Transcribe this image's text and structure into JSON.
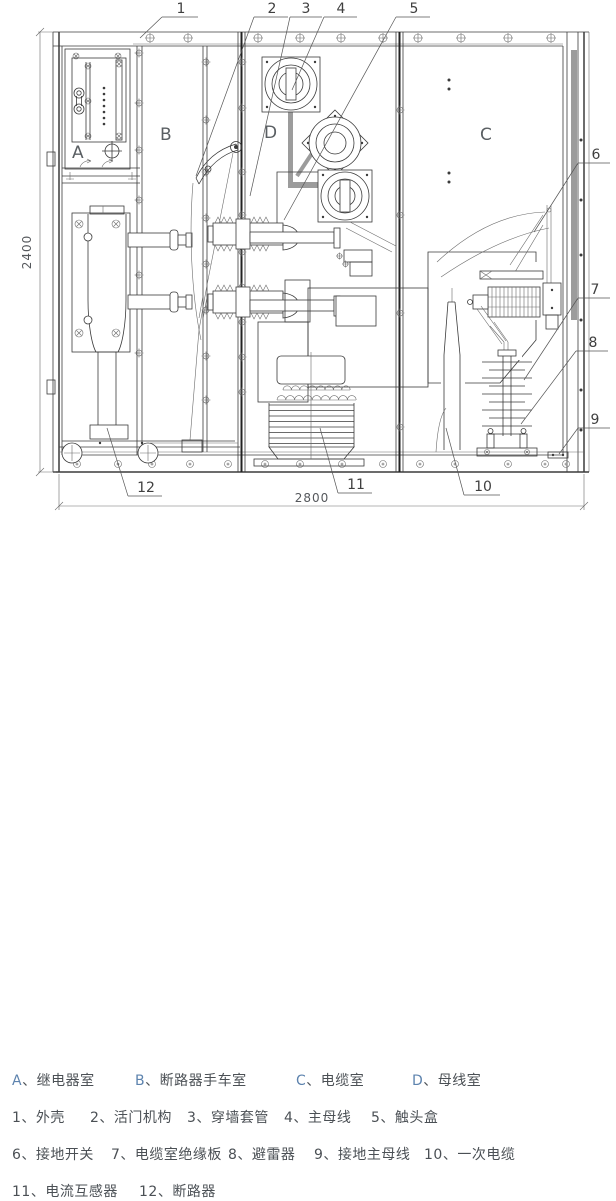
{
  "drawing": {
    "compartment_labels": {
      "a": "A",
      "b": "B",
      "c": "C",
      "d": "D"
    },
    "callouts": {
      "c1": "1",
      "c2": "2",
      "c3": "3",
      "c4": "4",
      "c5": "5",
      "c6": "6",
      "c7": "7",
      "c8": "8",
      "c9": "9",
      "c10": "10",
      "c11": "11",
      "c12": "12"
    },
    "dimensions": {
      "height": "2400",
      "width": "2800"
    }
  },
  "legend": {
    "separator": "、",
    "rows": [
      {
        "items": [
          {
            "key": "A",
            "name": "继电器室"
          },
          {
            "key": "B",
            "name": "断路器手车室"
          },
          {
            "key": "C",
            "name": "电缆室"
          },
          {
            "key": "D",
            "name": "母线室"
          }
        ]
      },
      {
        "items": [
          {
            "key": "1",
            "name": "外壳"
          },
          {
            "key": "2",
            "name": "活门机构"
          },
          {
            "key": "3",
            "name": "穿墙套管"
          },
          {
            "key": "4",
            "name": "主母线"
          },
          {
            "key": "5",
            "name": "触头盒"
          }
        ]
      },
      {
        "items": [
          {
            "key": "6",
            "name": "接地开关"
          },
          {
            "key": "7",
            "name": "电缆室绝缘板"
          },
          {
            "key": "8",
            "name": "避雷器"
          },
          {
            "key": "9",
            "name": "接地主母线"
          },
          {
            "key": "10",
            "name": "一次电缆"
          }
        ]
      },
      {
        "items": [
          {
            "key": "11",
            "name": "电流互感器"
          },
          {
            "key": "12",
            "name": "断路器"
          }
        ]
      }
    ]
  }
}
